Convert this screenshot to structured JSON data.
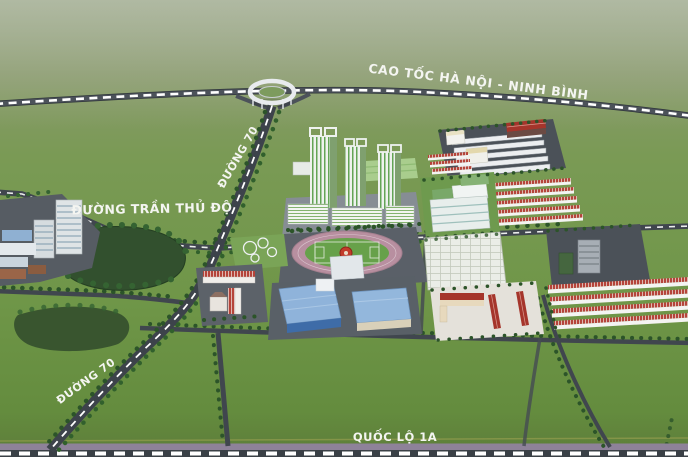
{
  "scene": {
    "labels": {
      "highway": "CAO TỐC HÀ NỘI - NINH BÌNH",
      "road70_upper": "ĐƯỜNG 70",
      "road70_lower": "ĐƯỜNG 70",
      "tran_thu_do": "ĐƯỜNG TRẦN THỦ ĐỘ",
      "quoc_lo_1a": "QUỐC LỘ 1A"
    },
    "colors": {
      "field_green": "#6f9446",
      "field_green_hazy": "#95a381",
      "field_green_dark": "#5d7c3a",
      "road_dark": "#3d434b",
      "road_marking": "#ffffff",
      "frontage_purple": "#8e8299",
      "pond_green": "#33502e",
      "tree_green": "#2c5429",
      "tower_stripe_green": "#63a455",
      "roof_blue": "#8fb3da",
      "roof_red": "#a5352b",
      "track_pink": "#b88fa0",
      "pitch_green": "#67a14a"
    }
  }
}
